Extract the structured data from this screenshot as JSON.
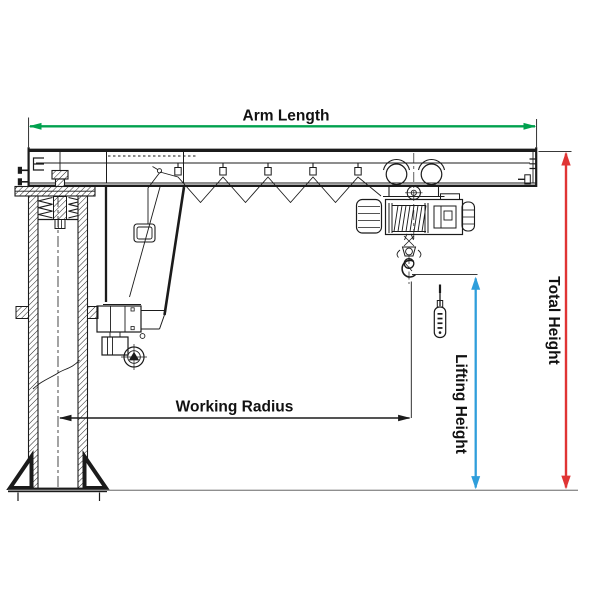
{
  "diagram": {
    "labels": {
      "arm_length": "Arm Length",
      "total_height": "Total Height",
      "lifting_height": "Lifting Height",
      "working_radius": "Working Radius"
    },
    "colors": {
      "drawing": "#1b1b1b",
      "arm_length": "#00a14e",
      "total_height": "#e03434",
      "lifting_height": "#2f9edb",
      "working_radius": "#1b1b1b",
      "ground": "#8f8f8f"
    }
  }
}
